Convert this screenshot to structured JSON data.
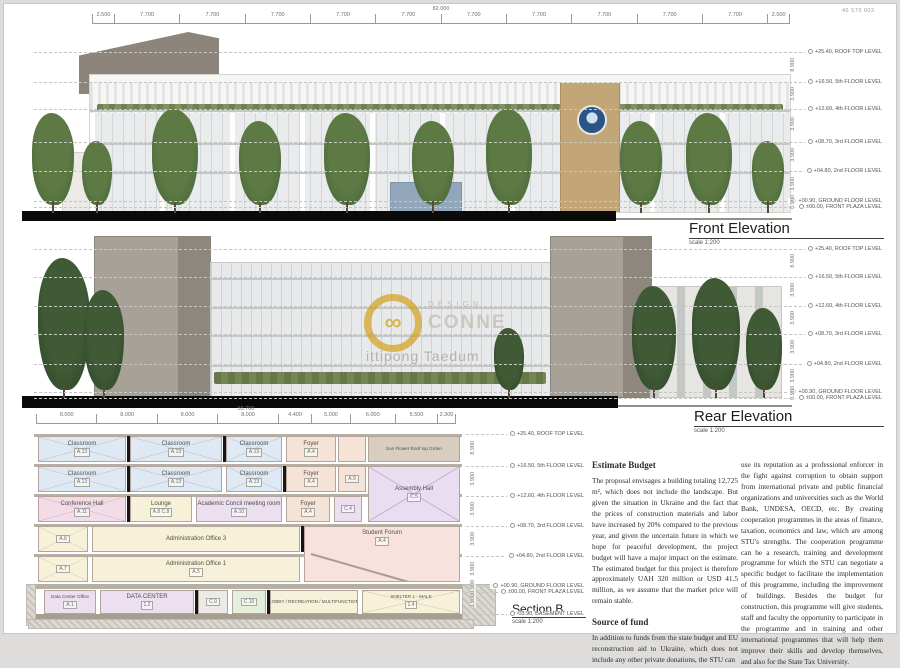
{
  "sheet": {
    "code": "46 573 002"
  },
  "front_elevation": {
    "title": "Front Elevation",
    "scale": "scale 1:200",
    "total_dim": "82.000",
    "dims": [
      "2.500",
      "7.700",
      "7.700",
      "7.700",
      "7.700",
      "7.700",
      "7.700",
      "7.700",
      "7.700",
      "7.700",
      "7.700",
      "2.500"
    ],
    "levels": [
      {
        "value": "+25.40",
        "label": "ROOF TOP LEVEL"
      },
      {
        "value": "+16.50",
        "label": "5th FLOOR LEVEL"
      },
      {
        "value": "+12.60",
        "label": "4th FLOOR LEVEL"
      },
      {
        "value": "+08.70",
        "label": "3rd FLOOR LEVEL"
      },
      {
        "value": "+04.80",
        "label": "2nd FLOOR LEVEL"
      },
      {
        "value": "+00.90",
        "label": "GROUND FLOOR LEVEL"
      },
      {
        "value": "±00.00",
        "label": "FRONT PLAZA LEVEL"
      }
    ],
    "floor_dims": [
      "8.900",
      "3.900",
      "3.900",
      "3.900",
      "3.900",
      "0.900"
    ]
  },
  "rear_elevation": {
    "title": "Rear Elevation",
    "scale": "scale 1:200",
    "levels": [
      {
        "value": "+25.40",
        "label": "ROOF TOP LEVEL"
      },
      {
        "value": "+16.50",
        "label": "5th FLOOR LEVEL"
      },
      {
        "value": "+12.60",
        "label": "4th FLOOR LEVEL"
      },
      {
        "value": "+08.70",
        "label": "3rd FLOOR LEVEL"
      },
      {
        "value": "+04.80",
        "label": "2nd FLOOR LEVEL"
      },
      {
        "value": "+00.90",
        "label": "GROUND FLOOR LEVEL"
      },
      {
        "value": "±00.00",
        "label": "FRONT PLAZA LEVEL"
      }
    ],
    "floor_dims": [
      "8.900",
      "3.900",
      "3.900",
      "3.900",
      "3.900",
      "0.900"
    ]
  },
  "section": {
    "title": "Section B",
    "scale": "scale 1:200",
    "total_dim": "55.700",
    "dims": [
      "8.000",
      "8.000",
      "8.000",
      "8.000",
      "4.400",
      "5.000",
      "6.000",
      "5.500",
      "2.300"
    ],
    "levels": [
      {
        "value": "+25.40",
        "label": "ROOF TOP LEVEL"
      },
      {
        "value": "+16.50",
        "label": "5th FLOOR LEVEL"
      },
      {
        "value": "+12.60",
        "label": "4th FLOOR LEVEL"
      },
      {
        "value": "+08.70",
        "label": "3rd FLOOR LEVEL"
      },
      {
        "value": "+04.80",
        "label": "2nd FLOOR LEVEL"
      },
      {
        "value": "+00.90",
        "label": "GROUND FLOOR LEVEL"
      },
      {
        "value": "±00.00",
        "label": "FRONT PLAZA LEVEL"
      },
      {
        "value": "-03.90",
        "label": "BASEMENT LEVEL"
      }
    ],
    "floor_dims": [
      "8.900",
      "3.900",
      "3.900",
      "3.900",
      "3.900",
      "0.900",
      "3.900"
    ],
    "rooms": [
      {
        "label": "Classroom",
        "code": "A.13"
      },
      {
        "label": "Classroom",
        "code": "A.13"
      },
      {
        "label": "Classroom",
        "code": "A.13"
      },
      {
        "label": "Foyer",
        "code": "A.4"
      },
      {
        "label": "Sun Flower Roof top Grden",
        "code": ""
      },
      {
        "label": "Classroom",
        "code": "A.13"
      },
      {
        "label": "Classroom",
        "code": "A.13"
      },
      {
        "label": "Classroom",
        "code": "A.13"
      },
      {
        "label": "Foyer",
        "code": "A.4"
      },
      {
        "label": "",
        "code": "A.9"
      },
      {
        "label": "Assembly Hall",
        "code": "C.5"
      },
      {
        "label": "Conference Hall",
        "code": "A.11"
      },
      {
        "label": "Lounge",
        "code": "A.8  C.8"
      },
      {
        "label": "Academic Concil meeting room",
        "code": "A.10"
      },
      {
        "label": "Foyer",
        "code": "A.4"
      },
      {
        "label": "",
        "code": "C.4"
      },
      {
        "label": "",
        "code": "A.6"
      },
      {
        "label": "Administration Office 3",
        "code": ""
      },
      {
        "label": "Student Forum",
        "code": "A.4"
      },
      {
        "label": "",
        "code": "A.7"
      },
      {
        "label": "Administration Office 1",
        "code": "A.5"
      },
      {
        "label": "Data Center Office",
        "code": "A.1"
      },
      {
        "label": "DATA CENTER",
        "code": "1.2"
      },
      {
        "label": "",
        "code": "C.9"
      },
      {
        "label": "",
        "code": "C.10"
      },
      {
        "label": "LOBBY / RECREATION / MULTIFUNCTION",
        "code": ""
      },
      {
        "label": "SHELTER 1 - MALE",
        "code": "1.4"
      }
    ]
  },
  "watermark": {
    "line1": "DESIGN",
    "line2": "CONNE",
    "name": "ittipong Taedum"
  },
  "text_panel": {
    "heading1": "Estimate Budget",
    "para1": "The proposal envisages a building totaling 12,725 m², which does not include the landscape. But given the situation in Ukraine and the fact that the prices of construction materials and labor have increased by 20% compared to the previous year, and given the uncertain future in which we hope for peaceful development, the project budget will have a major impact on the estimate. The estimated budget for this project is therefore approximately UAH 320 million or USD 41.5 million, as we assume that the market price will remain stable.",
    "heading2": "Source of fund",
    "para2": "In addition to funds from the state budget and EU reconstruction aid to Ukraine, which does not include any other private donations, the STU can",
    "col2_para": "use its reputation as a professional enforcer in the fight against corruption to obtain support from international private and public financial organizations and universities such as the World Bank, UNDESA, OECD, etc. By creating cooperation programmes in the areas of finance, taxation, economics and law, which are among STU's strengths. The cooperation programme can be a research, training and development programme for which the STU can negotiate a specific budget to facilitate the implementation of this programme, including the improvement of buildings. Besides the budget for construction, this programme will give students, staff and faculty the opportunity to participate in the programme and in training and other international programmes that will help them improve their skills and develop themselves, and also for the State Tax University."
  }
}
